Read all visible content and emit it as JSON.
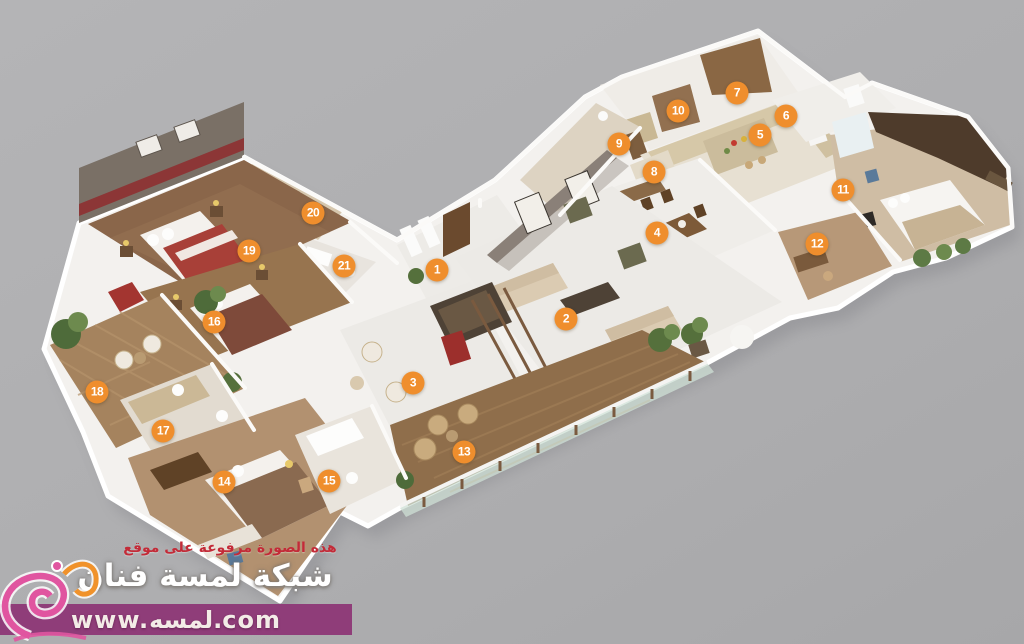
{
  "watermark": {
    "line1": "هذه الصورة مرفوعة على موقع",
    "line2": "شبكة لمسة فنان",
    "banner_url": "www.لمسه.com"
  },
  "markers": [
    {
      "label": "1",
      "x": 437,
      "y": 270
    },
    {
      "label": "2",
      "x": 566,
      "y": 319
    },
    {
      "label": "3",
      "x": 413,
      "y": 383
    },
    {
      "label": "4",
      "x": 657,
      "y": 233
    },
    {
      "label": "5",
      "x": 760,
      "y": 135
    },
    {
      "label": "6",
      "x": 786,
      "y": 116
    },
    {
      "label": "7",
      "x": 737,
      "y": 93
    },
    {
      "label": "8",
      "x": 654,
      "y": 172
    },
    {
      "label": "9",
      "x": 619,
      "y": 144
    },
    {
      "label": "10",
      "x": 678,
      "y": 111
    },
    {
      "label": "11",
      "x": 843,
      "y": 190
    },
    {
      "label": "12",
      "x": 817,
      "y": 244
    },
    {
      "label": "13",
      "x": 464,
      "y": 452
    },
    {
      "label": "14",
      "x": 224,
      "y": 482
    },
    {
      "label": "15",
      "x": 329,
      "y": 481
    },
    {
      "label": "16",
      "x": 214,
      "y": 322
    },
    {
      "label": "17",
      "x": 163,
      "y": 431
    },
    {
      "label": "18",
      "x": 97,
      "y": 392
    },
    {
      "label": "19",
      "x": 249,
      "y": 251
    },
    {
      "label": "20",
      "x": 313,
      "y": 213
    },
    {
      "label": "21",
      "x": 344,
      "y": 266
    }
  ],
  "colors": {
    "background": "#aeaeb0",
    "marker": "#ef8e2d",
    "banner": "#8f3d79",
    "watermark_red": "#c32b38",
    "logo_pink": "#e055a0",
    "logo_orange": "#f0922b"
  }
}
